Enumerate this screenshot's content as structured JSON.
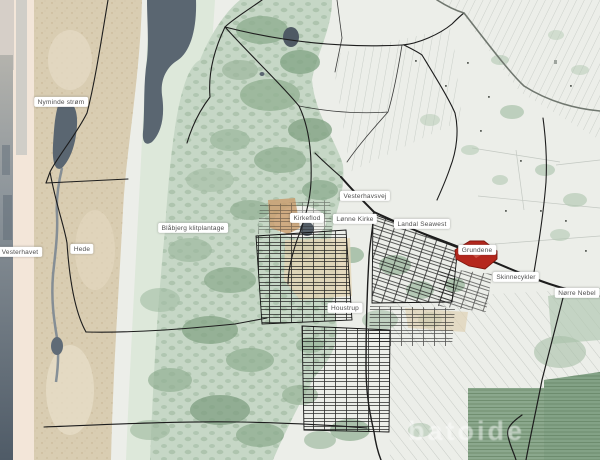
{
  "map": {
    "description": "Topographic web map of Danish west-coast area around Houstrup / Noerre Nebel with highlighted parcel at Grundene",
    "labels": [
      {
        "text": "Nyminde strøm",
        "x": 61,
        "y": 102
      },
      {
        "text": "Vesterhavet",
        "x": 20,
        "y": 252
      },
      {
        "text": "Hede",
        "x": 82,
        "y": 249
      },
      {
        "text": "Blåbjerg klitplantage",
        "x": 193,
        "y": 228
      },
      {
        "text": "Kirkeflod",
        "x": 307,
        "y": 218
      },
      {
        "text": "Vesterhavsvej",
        "x": 365,
        "y": 196
      },
      {
        "text": "Lønne Kirke",
        "x": 355,
        "y": 219
      },
      {
        "text": "Landal Seawest",
        "x": 422,
        "y": 224
      },
      {
        "text": "Grundene",
        "x": 477,
        "y": 250
      },
      {
        "text": "Skinnecykler",
        "x": 516,
        "y": 277
      },
      {
        "text": "Nørre Nebel",
        "x": 577,
        "y": 293
      },
      {
        "text": "Houstrup",
        "x": 345,
        "y": 308
      }
    ],
    "watermark": "batoide",
    "highlighted_parcel": "Grundene",
    "colors": {
      "highlight_fill": "#b5271d",
      "highlight_stroke": "#7e160e",
      "sea": "#4f5b67",
      "beach": "#f3e6d9",
      "dunes": "#d9cdb2",
      "forest": "#c6d7c6",
      "forest_dark": "#84a486",
      "fields": "#eceee9",
      "water_channel": "#5a6671",
      "road": "#1d1d1d",
      "label_bg": "#ffffff",
      "label_text": "#4e4e4e"
    }
  }
}
